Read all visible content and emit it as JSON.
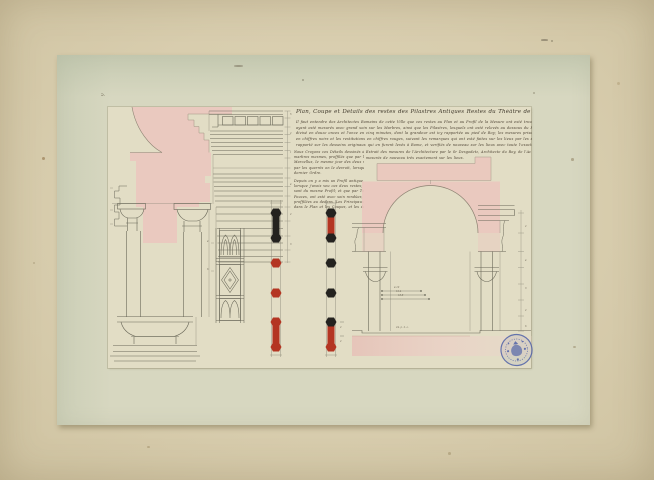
{
  "artwork": {
    "corner_mark": "5.",
    "title": "Plan, Coupe et Détails des restes des Pilastres Antiques Restes du Théâtre de Marcellus à Rome.",
    "intro_lines": [
      "Il faut entendre des Architectes Romains de cette Ville que ces restes au Plan et au Profil de la Mesure ont esté trouvés sur le lieu mesme du Theatre dont on rend compte icy",
      "ayant esté mesurés avec grand soin sur les Marbres, ainsi que les Pilastres, lesquels ont esté relevés au dessous du Portique, et les Profils cy dessus marqués par un Palme Romain",
      "divisé en douze onces et l'once en cinq minutes, dont la grandeur est icy rapportée au pied de Roy; les mesures prises sur les Marbres mesmes du Theatre de Marcellus sont escrites",
      "en chiffres noirs et les restitutions en chiffres rouges, suivant les remarques qui ont esté faites sur les lieux par les soins et ordres de l'Académie Royale d'Architecture, le tout",
      "rapporté sur les desseins originaux qui en furent levés à Rome, et verifiés de nouveau sur les lieux avec toute l'exactitude possible par les pensionnaires du Roy."
    ],
    "left_column_lines": [
      "Nous Croyons ces Détails dessinés d'après les",
      "marbres mesmes, proffilés que par le Théâtre de",
      "Marcellus, le mesme jour des deux mesures;",
      "par les quarrés on le devroit, lorsque leur",
      "dernier Ordre.",
      "Depuis on y a mis un Profil antique,",
      "lorsque j'avois veu ces deux restes; mesures que",
      "sont du mesme Profil; et que par Toises, Pieds,",
      "Pouces, ont esté avec soin rendües, ainsi que",
      "proffilées au dedans. Les Principaux Desseins",
      "dans le Plan et les Coupes, et les détails et suite."
    ],
    "right_column_lines": [
      "Extrait des mesures de l'Architecture par le Sr Desgodetz, Architecte du Roy, de l'Académie Royale, et des restes antiques les mieux conservés qui soient à Rome,",
      "mesurés de nouveau très exactement sur les lieux."
    ],
    "dimensions": {
      "arch_widths": [
        "4.10",
        "12.4",
        "18.8"
      ],
      "ground_width": "24. p. 2. o.",
      "entablature_chain": [
        "5",
        "2",
        "1",
        "4",
        "2",
        "3"
      ],
      "right_chain": [
        "2",
        "4",
        "3",
        "2",
        "6"
      ],
      "soffit_marks": [
        "4",
        "6"
      ],
      "bar_marks": [
        "2",
        "2"
      ]
    },
    "scale_bars": [
      {
        "name": "tie-bar-left",
        "cx": 276,
        "knobs": [
          "black",
          "black",
          "red",
          "red",
          "red",
          "red"
        ],
        "shafts": [
          "black",
          "plain",
          "plain",
          "plain",
          "red"
        ]
      },
      {
        "name": "tie-bar-right",
        "cx": 331,
        "knobs": [
          "black",
          "black",
          "black",
          "black",
          "black",
          "red"
        ],
        "shafts": [
          "red",
          "plain",
          "plain",
          "plain",
          "red"
        ]
      }
    ],
    "knob_y": [
      213,
      238,
      263,
      293,
      322,
      347
    ],
    "colors": {
      "mount": "#d8cdae",
      "sheet": "#d7d7c0",
      "plate": "#e2ddc5",
      "wash_pink": "#ebc7be",
      "ink": "#6b695a",
      "ink_light": "#8f8d7c",
      "text_ink": "#4b4032",
      "red": "#b43522",
      "black": "#24221f",
      "stamp_blue": "#4f61a8"
    },
    "stamp": {
      "name": "round blue collection stamp"
    }
  }
}
